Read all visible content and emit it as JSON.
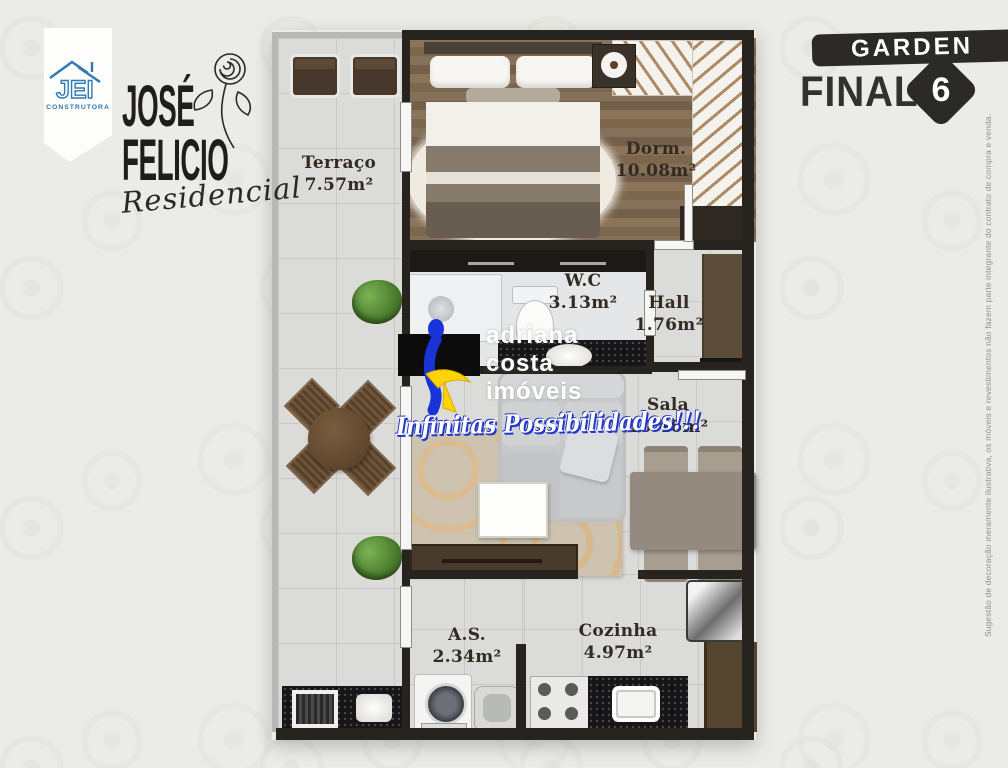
{
  "branding": {
    "builder": {
      "name": "JEI",
      "tagline": "CONSTRUTORA"
    },
    "project": {
      "line1": "JOSÉ",
      "line2": "FELICIO",
      "subtitle": "Residencial"
    }
  },
  "unit_badge": {
    "collection": "GARDEN",
    "label": "FINAL",
    "number": "6"
  },
  "rooms": [
    {
      "id": "terraco",
      "name": "Terraço",
      "area": "7.57m²"
    },
    {
      "id": "dorm",
      "name": "Dorm.",
      "area": "10.08m²"
    },
    {
      "id": "wc",
      "name": "W.C",
      "area": "3.13m²"
    },
    {
      "id": "hall",
      "name": "Hall",
      "area": "1.76m²"
    },
    {
      "id": "sala",
      "name": "Sala",
      "area": "10.46m²"
    },
    {
      "id": "as",
      "name": "A.S.",
      "area": "2.34m²"
    },
    {
      "id": "cozinha",
      "name": "Cozinha",
      "area": "4.97m²"
    }
  ],
  "watermark": {
    "line1": "adriana",
    "line2": "costa",
    "line3": "imóveis",
    "slogan": "Infinitas Possibilidades!!!"
  },
  "disclaimer": "Sugestão de decoração meramente ilustrativa, os móveis e revestimentos não fazem parte integrante do contrato de compra e venda.",
  "colors": {
    "banner_dark": "#2b2a27",
    "jei_blue": "#2f79b5",
    "watermark_blue": "#1834d6",
    "watermark_yellow": "#ffd400",
    "wall_dark": "#272420"
  }
}
